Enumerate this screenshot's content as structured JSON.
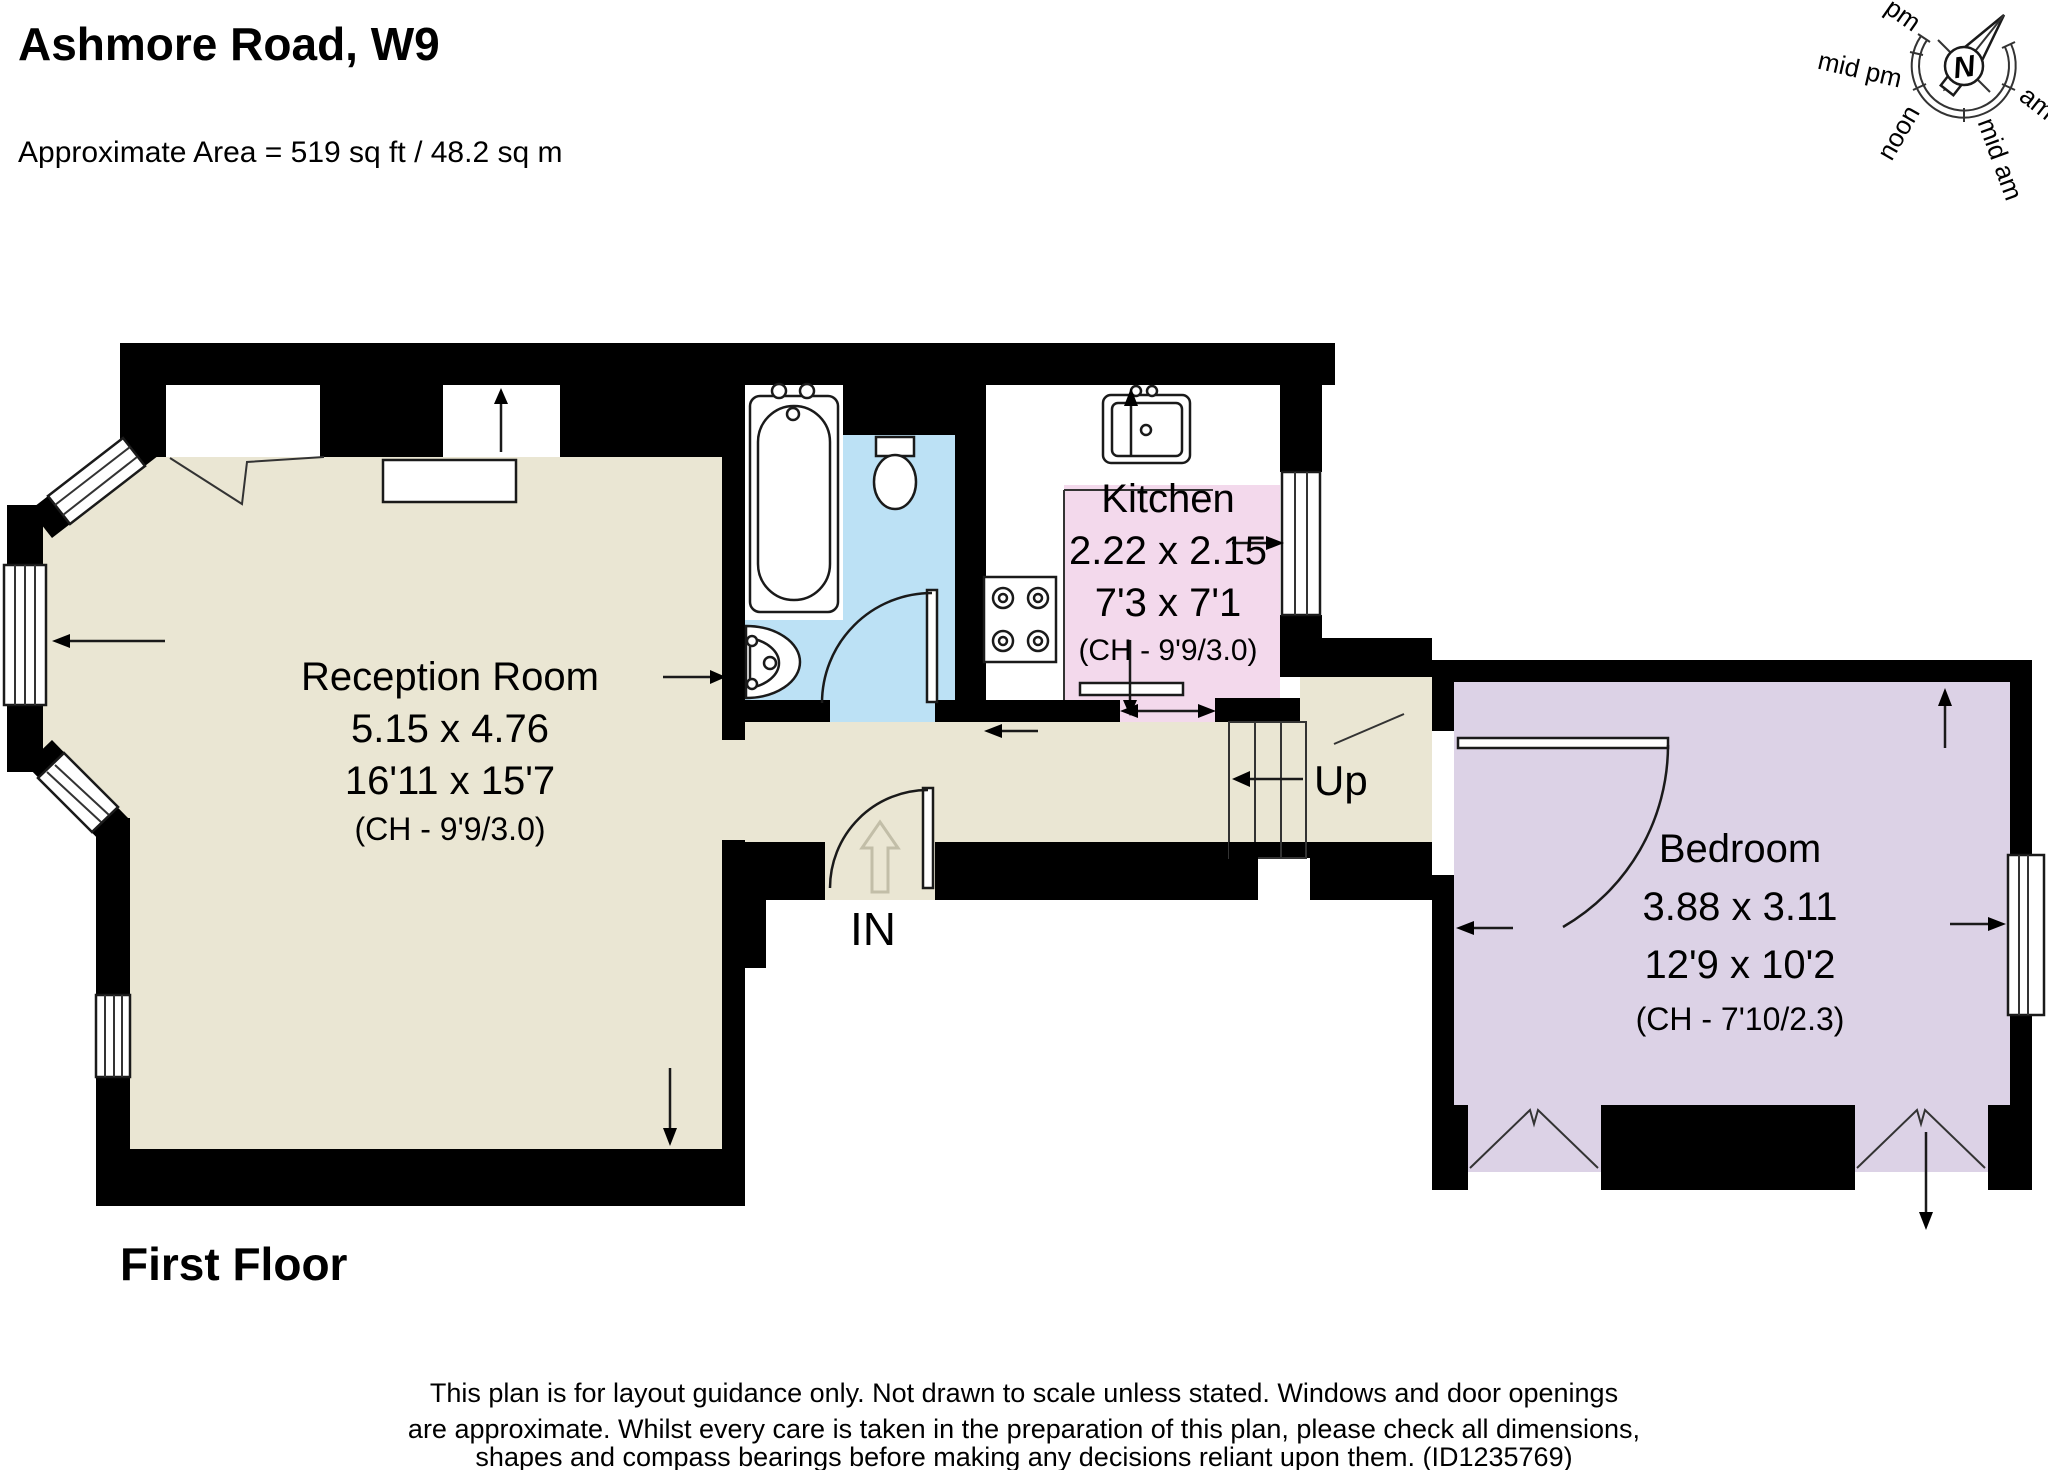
{
  "header": {
    "title": "Ashmore Road, W9",
    "area_line": "Approximate Area = 519 sq ft / 48.2 sq m"
  },
  "floor_label": "First Floor",
  "compass": {
    "north": "N",
    "pm": "pm",
    "mid_pm": "mid pm",
    "noon": "noon",
    "mid_am": "mid am",
    "am": "am"
  },
  "rooms": {
    "reception": {
      "name": "Reception Room",
      "metric": "5.15 x 4.76",
      "imperial": "16'11 x 15'7",
      "ceiling": "(CH - 9'9/3.0)"
    },
    "kitchen": {
      "name": "Kitchen",
      "metric": "2.22 x 2.15",
      "imperial": "7'3 x 7'1",
      "ceiling": "(CH - 9'9/3.0)"
    },
    "bedroom": {
      "name": "Bedroom",
      "metric": "3.88 x 3.11",
      "imperial": "12'9 x 10'2",
      "ceiling": "(CH - 7'10/2.3)"
    }
  },
  "labels": {
    "up": "Up",
    "in": "IN"
  },
  "disclaimer": {
    "line1": "This plan is for layout guidance only. Not drawn to scale unless stated. Windows and door openings",
    "line2": "are approximate. Whilst every care is taken in the preparation of this plan, please check all dimensions,",
    "line3": "shapes and compass bearings before making any decisions reliant upon them. (ID1235769)"
  },
  "colors": {
    "reception": "#EAE6D3",
    "bathroom": "#BCE1F5",
    "kitchen": "#F3D9EC",
    "bedroom": "#DCD2E6",
    "wall": "#000000",
    "ghost": "#C2BEA8"
  }
}
